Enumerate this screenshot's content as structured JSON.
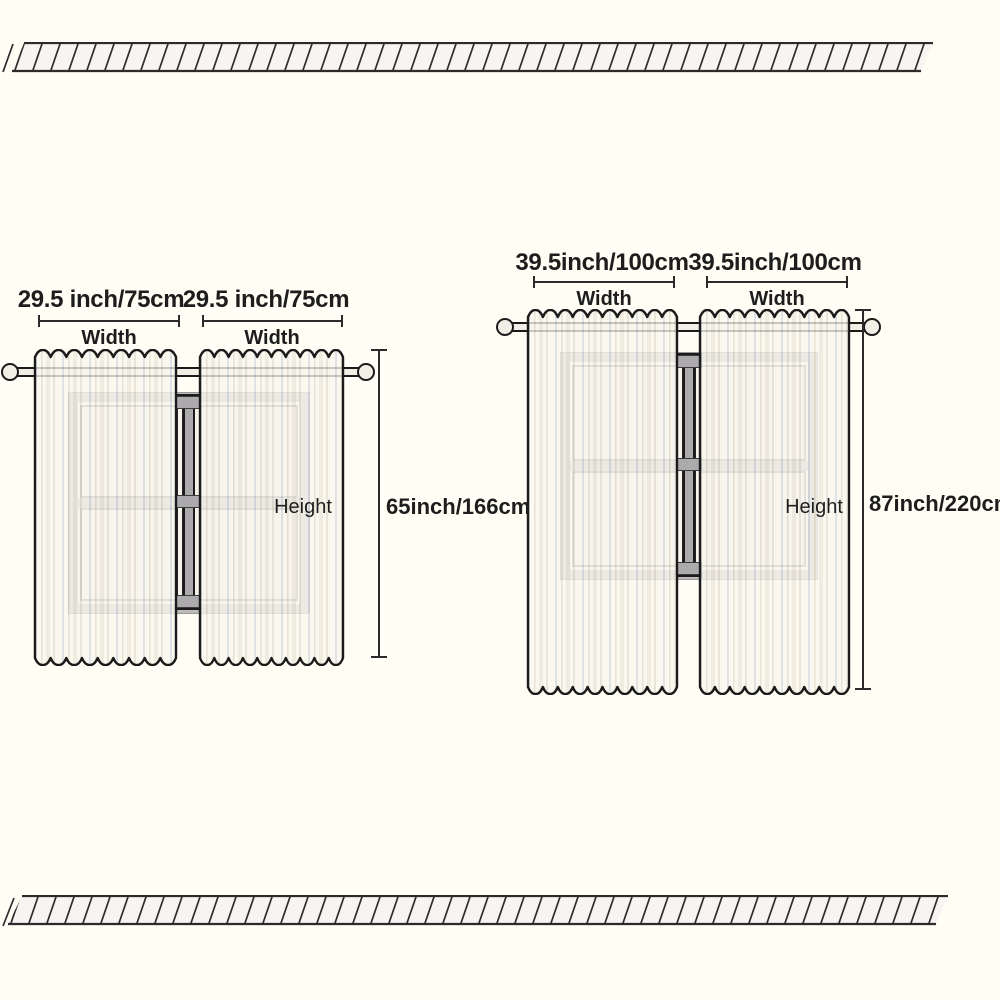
{
  "colors": {
    "background": "#FFFDF4",
    "outline": "#1b1b1b",
    "hatch_line": "#2e2e2e",
    "band_fill": "#F8F4F2",
    "curtain_fill": "#FAF7EE",
    "window_frame_gray": "#BDBCBB",
    "mullion_gray": "#ACAAAD"
  },
  "borders": {
    "top": "diagonal-hatched-band",
    "bottom": "diagonal-hatched-band"
  },
  "diagrams": {
    "small": {
      "panel1_size": "29.5 inch/75cm",
      "panel2_size": "29.5 inch/75cm",
      "panel1_width_label": "Width",
      "panel2_width_label": "Width",
      "height_label": "Height",
      "height_size": "65inch/166cm"
    },
    "large": {
      "panel1_size": "39.5inch/100cm",
      "panel2_size": "39.5inch/100cm",
      "panel1_width_label": "Width",
      "panel2_width_label": "Width",
      "height_label": "Height",
      "height_size": "87inch/220cm"
    }
  }
}
